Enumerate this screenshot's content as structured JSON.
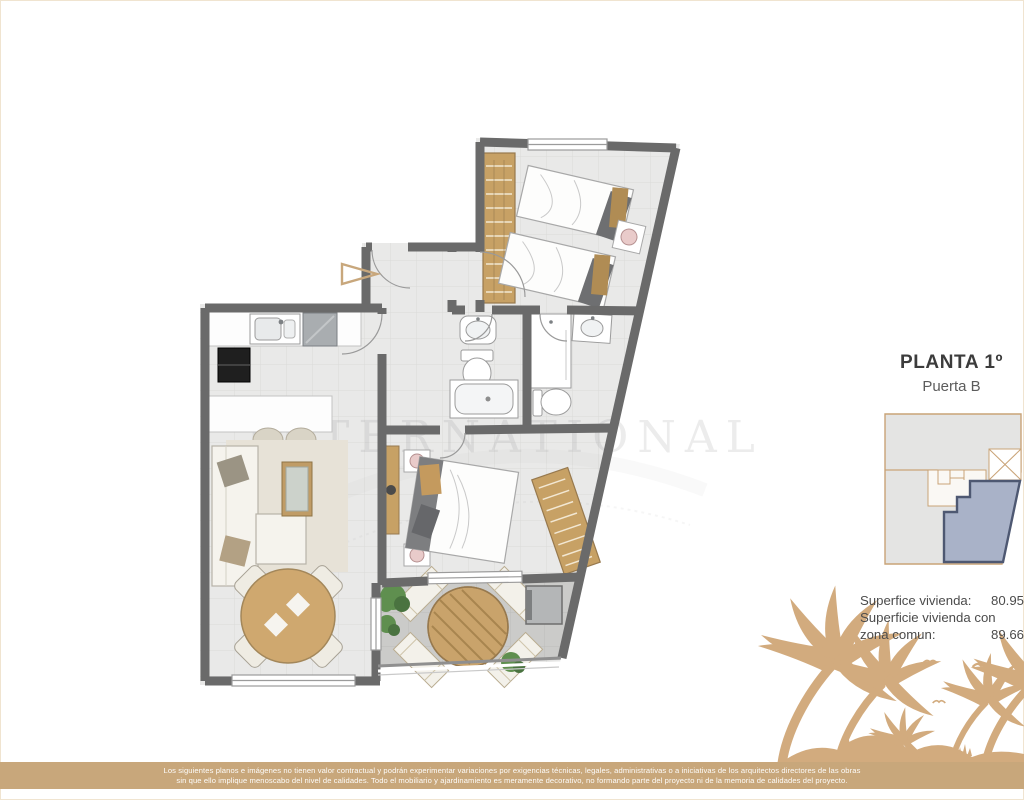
{
  "plan_card": {
    "title": "PLANTA 1º",
    "subtitle": "Puerta B"
  },
  "area_table": {
    "rows": [
      {
        "label": "Superfice vivienda:",
        "value": "80.95"
      },
      {
        "label": "Superficie vivienda con",
        "value": ""
      },
      {
        "label": "zona comun:",
        "value": "89.66"
      }
    ]
  },
  "watermark": {
    "text": "INTERNATIONAL"
  },
  "disclaimer": {
    "line1": "Los siguientes planos e imágenes no tienen valor contractual y podrán experimentar variaciones por exigencias técnicas, legales, administrativas o a iniciativas de los arquitectos directores de las obras",
    "line2": "sin que ello implique menoscabo del nivel de calidades. Todo el mobiliario y ajardinamiento es meramente decorativo, no formando parte del proyecto ni de la memoria de calidades del proyecto."
  },
  "colors": {
    "accent_tan": "#c8a77b",
    "palm_silhouette": "#d2ab7e",
    "wall_gray": "#6a6a6a",
    "floor_light": "#e9e9e8",
    "terrace_floor": "#cbcbc9",
    "wood_tan": "#c7a165",
    "unit_highlight_fill": "#a9b2c8",
    "unit_highlight_border": "#4e5872"
  }
}
